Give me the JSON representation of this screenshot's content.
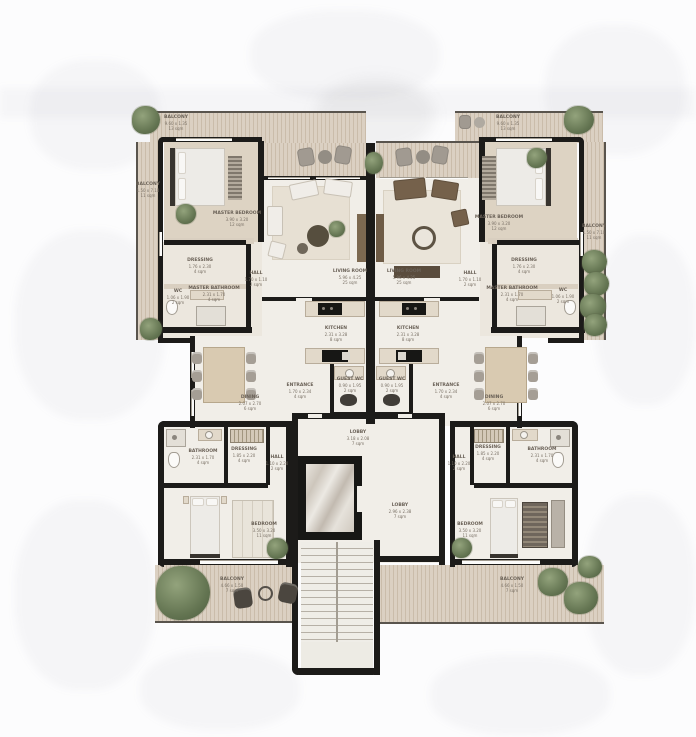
{
  "floorplan": {
    "type": "residential-floor-plan",
    "colors": {
      "wall": "#1c1b19",
      "deck": "#d9cdbd",
      "deck_stripe": "#cabcaa",
      "interior_floor": "#f1eee8",
      "bedroom_floor": "#ddd3c3",
      "partition": "#d9cfc0",
      "greenery": "#65754f",
      "wood": "#d9cab1",
      "dark_furniture": "#75614b",
      "label_text": "#6a6157",
      "background": "#fcfcfd"
    }
  },
  "labels": {
    "bal_top": {
      "n": "BALCONY",
      "d": "9.60 x 1.35",
      "a": "13 sqm"
    },
    "bal_side": {
      "n": "BALCONY",
      "d": "1.50 x 7.10",
      "a": "11 sqm"
    },
    "master_bed": {
      "n": "MASTER BEDROOM",
      "d": "3.90 x 3.20",
      "a": "12 sqm"
    },
    "dressing": {
      "n": "DRESSING",
      "d": "1.76 x 2.30",
      "a": "4 sqm"
    },
    "wc": {
      "n": "WC",
      "d": "1.06 x 1.90",
      "a": "2 sqm"
    },
    "master_bath": {
      "n": "MASTER BATHROOM",
      "d": "2.31 x 1.70",
      "a": "4 sqm"
    },
    "hall": {
      "n": "HALL",
      "d": "1.70 x 1.10",
      "a": "2 sqm"
    },
    "living": {
      "n": "LIVING ROOM",
      "d": "5.96 x 4.25",
      "a": "25 sqm"
    },
    "kitchen": {
      "n": "KITCHEN",
      "d": "2.31 x 3.28",
      "a": "8 sqm"
    },
    "dining": {
      "n": "DINING",
      "d": "2.07 x 2.70",
      "a": "6 sqm"
    },
    "entrance": {
      "n": "ENTRANCE",
      "d": "1.70 x 2.34",
      "a": "4 sqm"
    },
    "guest_wc": {
      "n": "GUEST WC",
      "d": "0.90 x 1.95",
      "a": "2 sqm"
    },
    "lobby_top": {
      "n": "LOBBY",
      "d": "3.18 x 2.08",
      "a": "7 sqm"
    },
    "lobby": {
      "n": "LOBBY",
      "d": "2.96 x 2.38",
      "a": "7 sqm"
    },
    "bedroom": {
      "n": "BEDROOM",
      "d": "3.50 x 3.20",
      "a": "11 sqm"
    },
    "bathroom": {
      "n": "BATHROOM",
      "d": "2.31 x 1.70",
      "a": "4 sqm"
    },
    "dressing2": {
      "n": "DRESSING",
      "d": "1.85 x 2.20",
      "a": "4 sqm"
    },
    "hall2": {
      "n": "HALL",
      "d": "1.10 x 2.20",
      "a": "2 sqm"
    },
    "bal_bottom": {
      "n": "BALCONY",
      "d": "4.66 x 1.50",
      "a": "7 sqm"
    }
  }
}
